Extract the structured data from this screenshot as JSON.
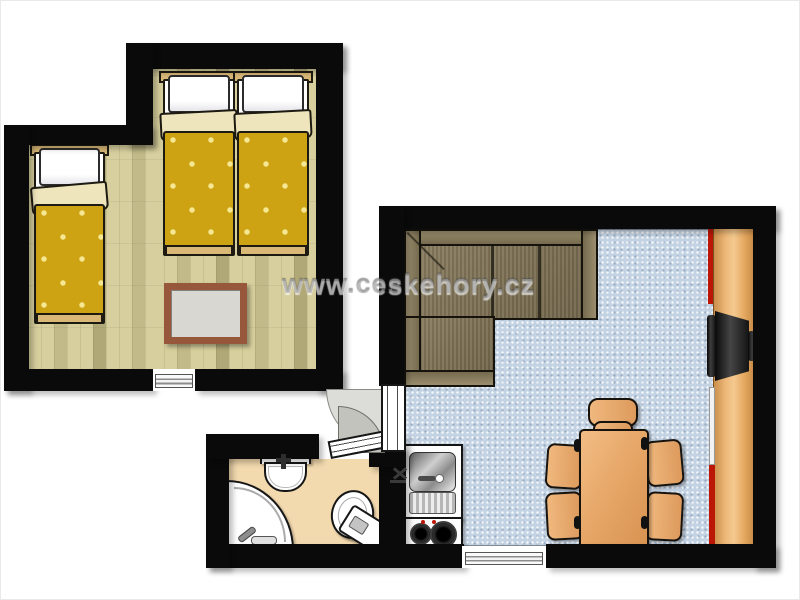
{
  "watermark": {
    "text": "www.ceskehory.cz"
  },
  "palette": {
    "wall": "#0a0a0a",
    "parquet": "#d7cf9d",
    "carpet": "#c4d3e3",
    "duvet": "#cda313",
    "duvet_dot": "#f6e793",
    "linen": "#efe5bd",
    "wood_trim": "#d9b877",
    "bath_floor": "#f2d9ae",
    "rug_frame": "#96573a",
    "rug_center": "#d9d7d2",
    "accent_red": "#bb1606"
  },
  "rooms": {
    "bedroom": {
      "furniture": [
        "single-bed",
        "single-bed",
        "single-bed",
        "rug",
        "window"
      ]
    },
    "living_room": {
      "furniture": [
        "corner-sofa",
        "tv",
        "tv-cabinet",
        "dining-table",
        "chair",
        "chair",
        "chair",
        "chair",
        "chair",
        "window"
      ]
    },
    "kitchenette": {
      "furniture": [
        "sink",
        "faucet",
        "two-burner-stove"
      ]
    },
    "bathroom": {
      "furniture": [
        "washbasin",
        "corner-shower-tub",
        "toilet",
        "door"
      ]
    }
  }
}
